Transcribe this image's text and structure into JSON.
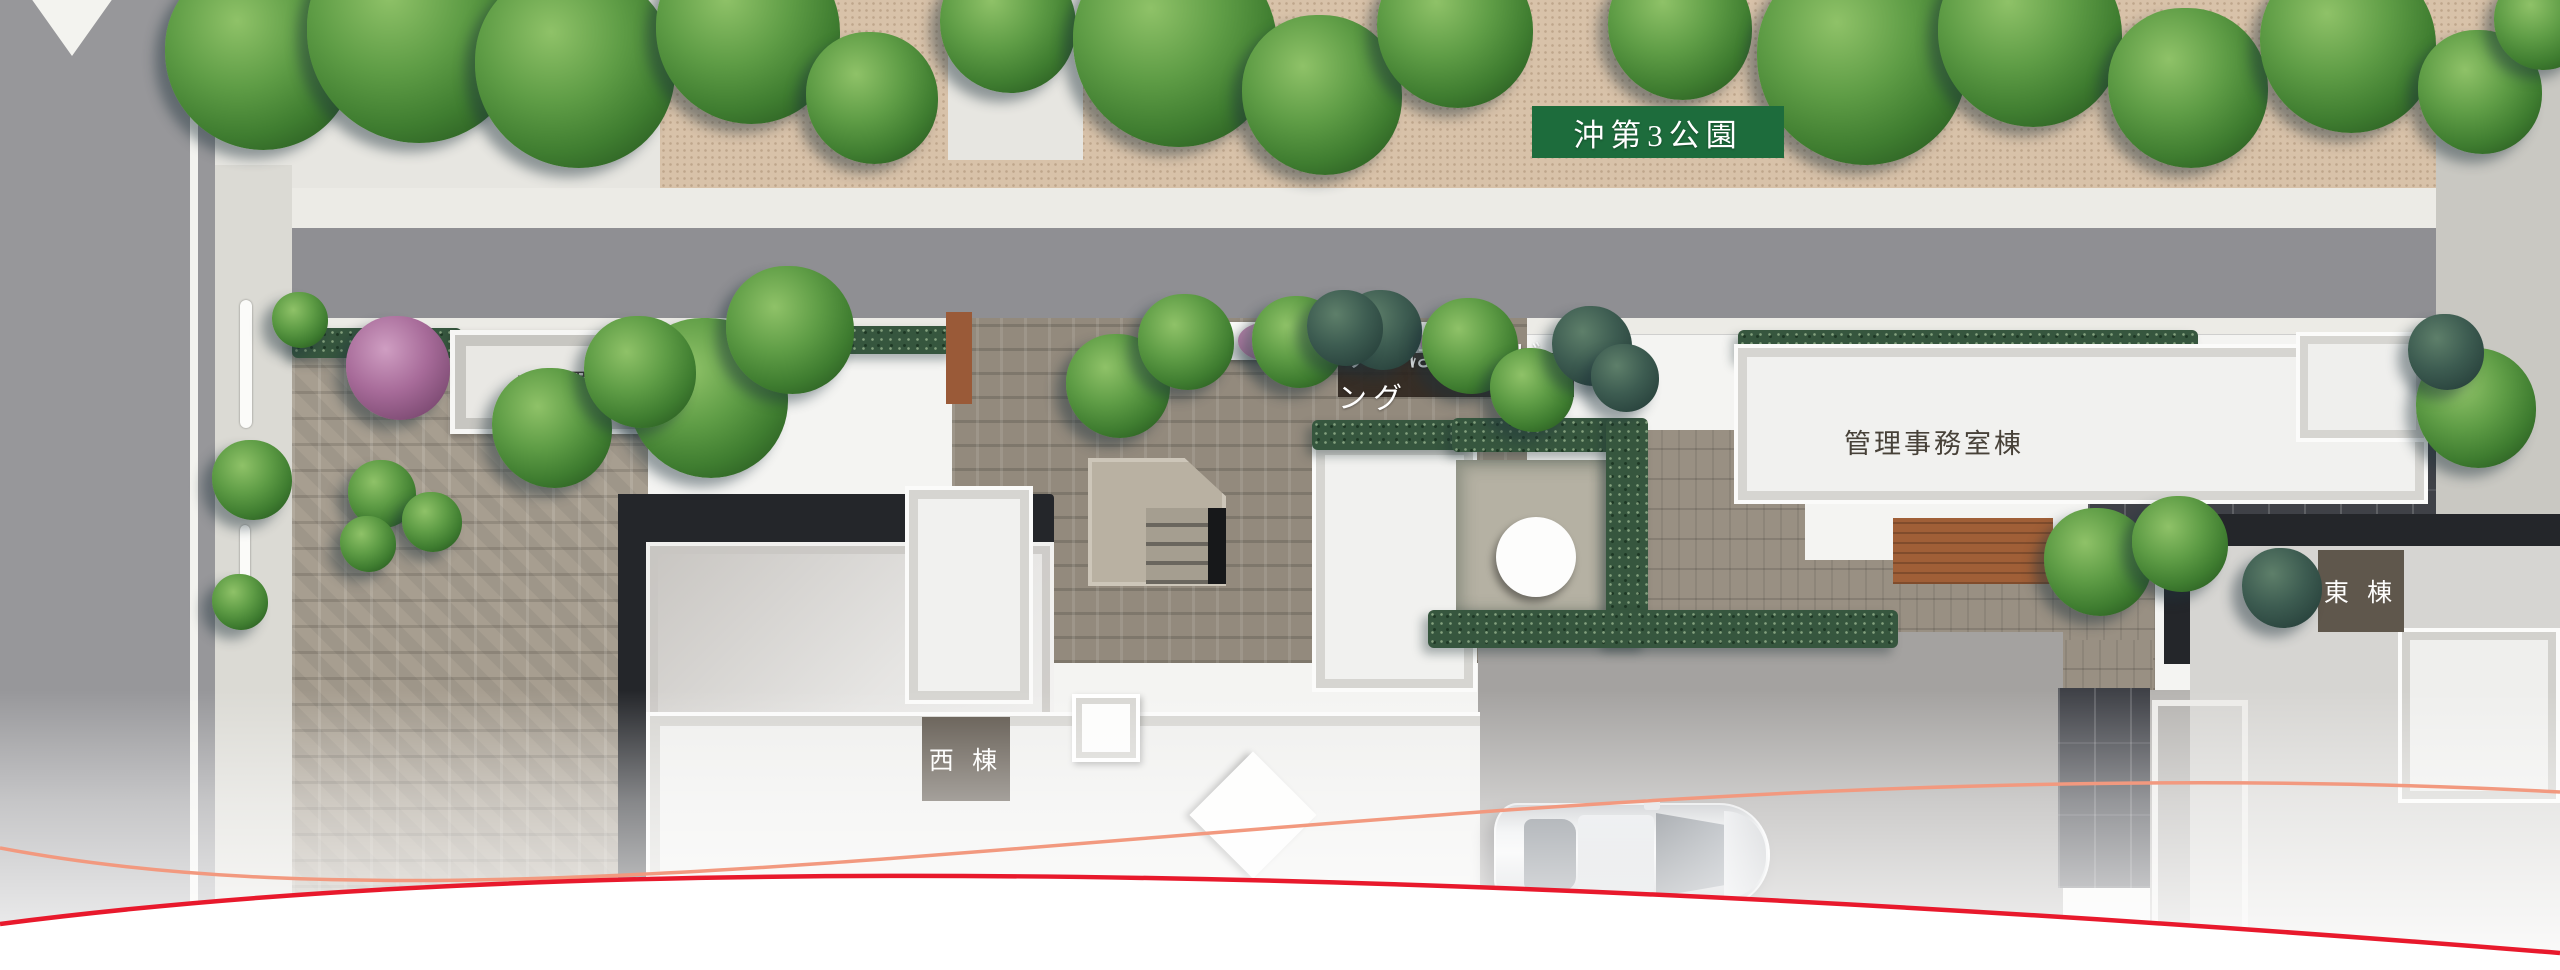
{
  "page": {
    "type": "residential-site-plan-rendering"
  },
  "labels": {
    "park": "沖第3公園",
    "garbage_station": "ゴミ置き場",
    "michibata_living": "みちばたリビング",
    "management_office": "管理事務室棟",
    "east_wing": "東 棟",
    "west_wing": "西 棟"
  },
  "colors": {
    "park_label_bg": "#1d6c3c",
    "michibata_band_bg": "#2a211a",
    "wing_badge_bg": "#5c544a",
    "accent_curve_red": "#e8192c",
    "accent_curve_salmon": "#f2997f"
  }
}
